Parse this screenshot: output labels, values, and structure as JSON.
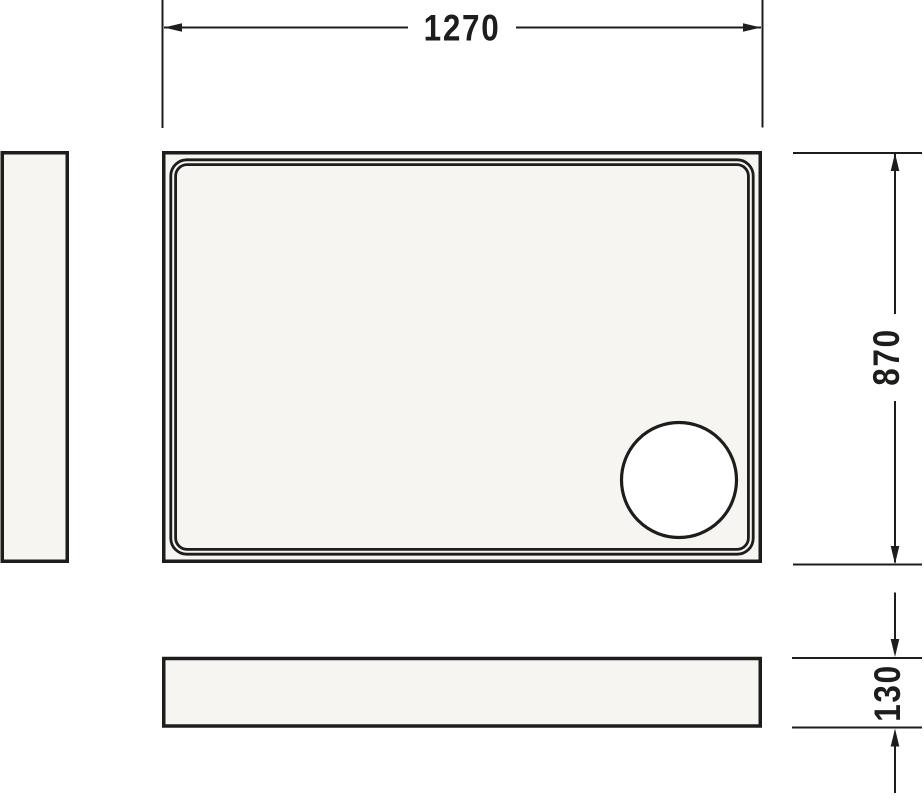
{
  "drawing": {
    "type": "technical-dimension-drawing",
    "colors": {
      "line": "#1d1d1b",
      "surface_fill": "#f7f5f2",
      "drain_fill": "#ffffff",
      "background": "#ffffff"
    },
    "dimensions": {
      "width": "1270",
      "height": "870",
      "depth": "130"
    }
  }
}
